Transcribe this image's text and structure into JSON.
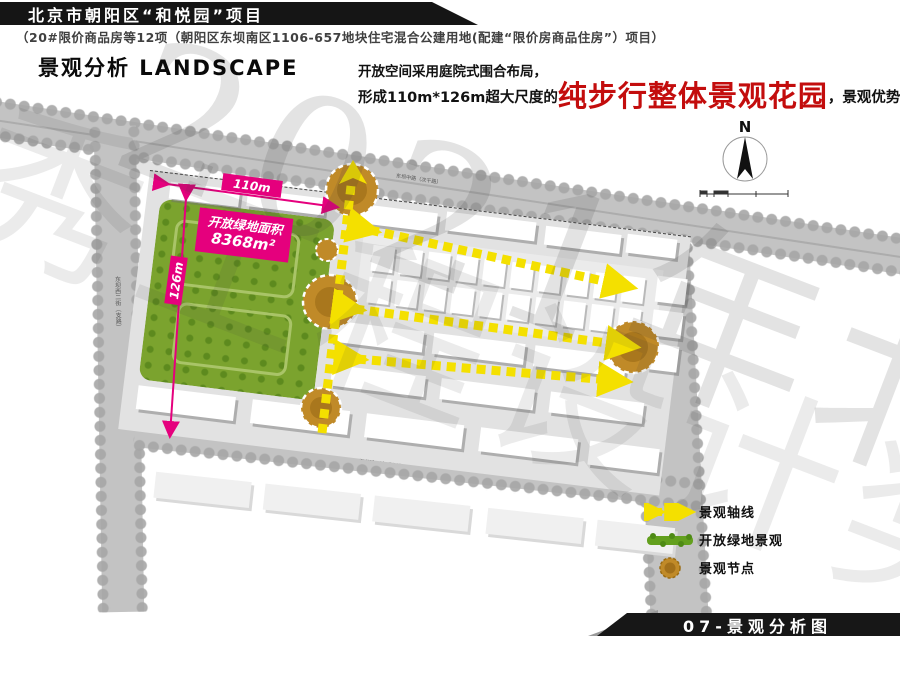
{
  "header": {
    "title": "北京市朝阳区“和悦园”项目",
    "subtitle": "（20#限价商品房等12项（朝阳区东坝南区1106-657地块住宅混合公建用地(配建“限价房商品住房”）项目）"
  },
  "section": {
    "heading": "景观分析 LANDSCAPE"
  },
  "description": {
    "line1": "开放空间采用庭院式围合布局，",
    "line2_prefix": "形成110m*126m超大尺度的",
    "highlight": "纯步行整体景观花园",
    "line2_suffix": "，景观优势突出。"
  },
  "watermark": {
    "line1": "2021年北京市",
    "line2": "优秀工程设计奖"
  },
  "compass": {
    "north_label": "N"
  },
  "plan": {
    "dim_width_label": "110m",
    "dim_height_label": "126m",
    "area_label_line1": "开放绿地面积",
    "area_label_line2": "8368m²",
    "roads": {
      "north": "东坝中路（次干路）",
      "south": "东坝南一街（支路）",
      "west": "东坝西二街（支路）",
      "east": "东坝东二路（城市主干路）"
    }
  },
  "legend": {
    "items": [
      {
        "label": "景观轴线"
      },
      {
        "label": "开放绿地景观"
      },
      {
        "label": "景观节点"
      }
    ]
  },
  "footer": {
    "page_label": "07-景观分析图"
  },
  "colors": {
    "magenta": "#e5007d",
    "yellow": "#f4e000",
    "green": "#7ba32e",
    "node": "#c08a28",
    "red": "#c30d0d"
  }
}
